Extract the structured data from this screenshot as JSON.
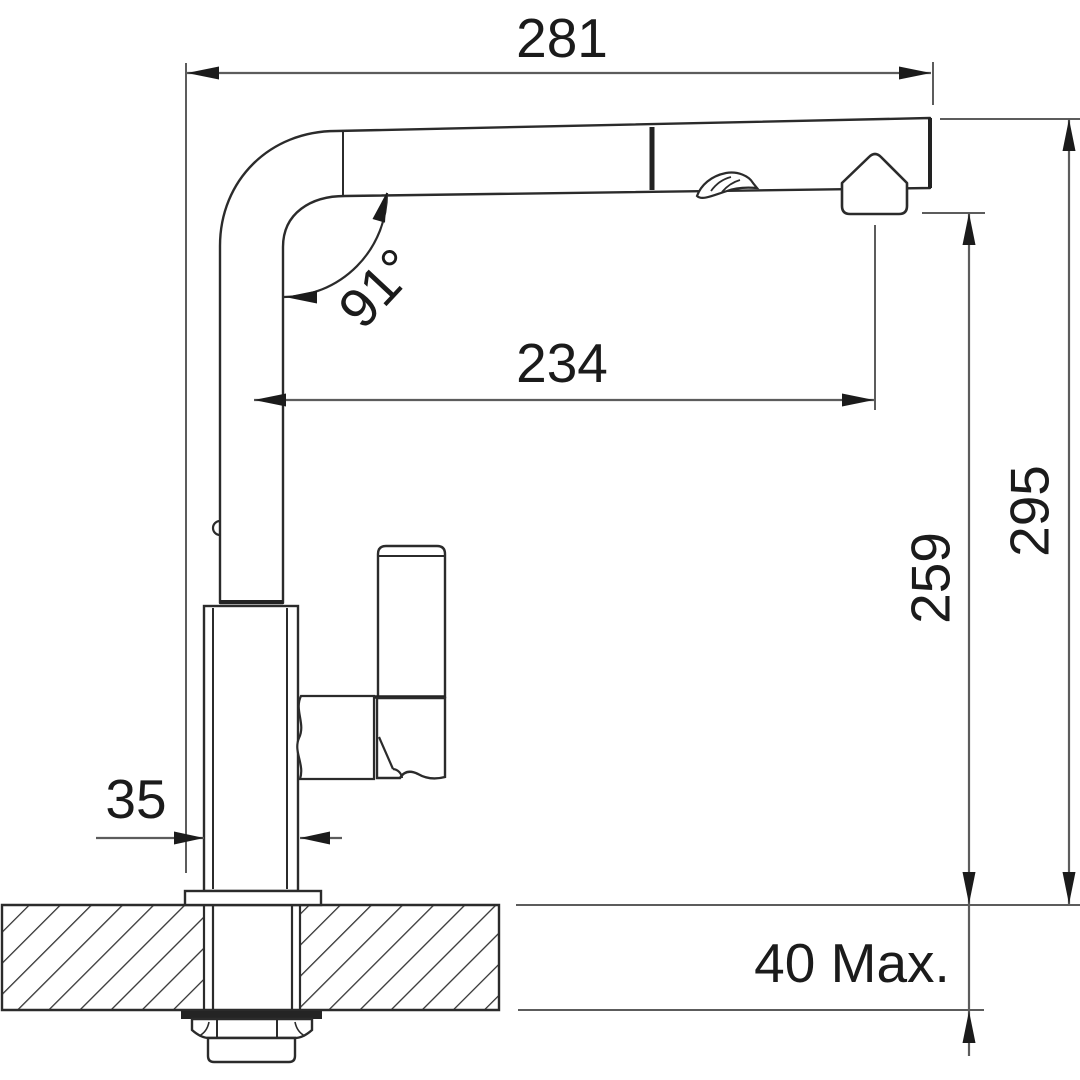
{
  "drawing": {
    "type": "technical dimension drawing",
    "subject": "kitchen pull-out faucet mounted through a counter top, side elevation with dimensions"
  },
  "labels": {
    "overall_width": "281",
    "spout_reach": "234",
    "spout_angle": "91°",
    "overall_height": "295",
    "outlet_height": "259",
    "body_width": "35",
    "deck_thickness": "40 Max."
  },
  "colors": {
    "object_line": "#2b2b2b",
    "dimension_line": "#5c5c5c",
    "text": "#1b1b1b",
    "background": "#ffffff"
  }
}
